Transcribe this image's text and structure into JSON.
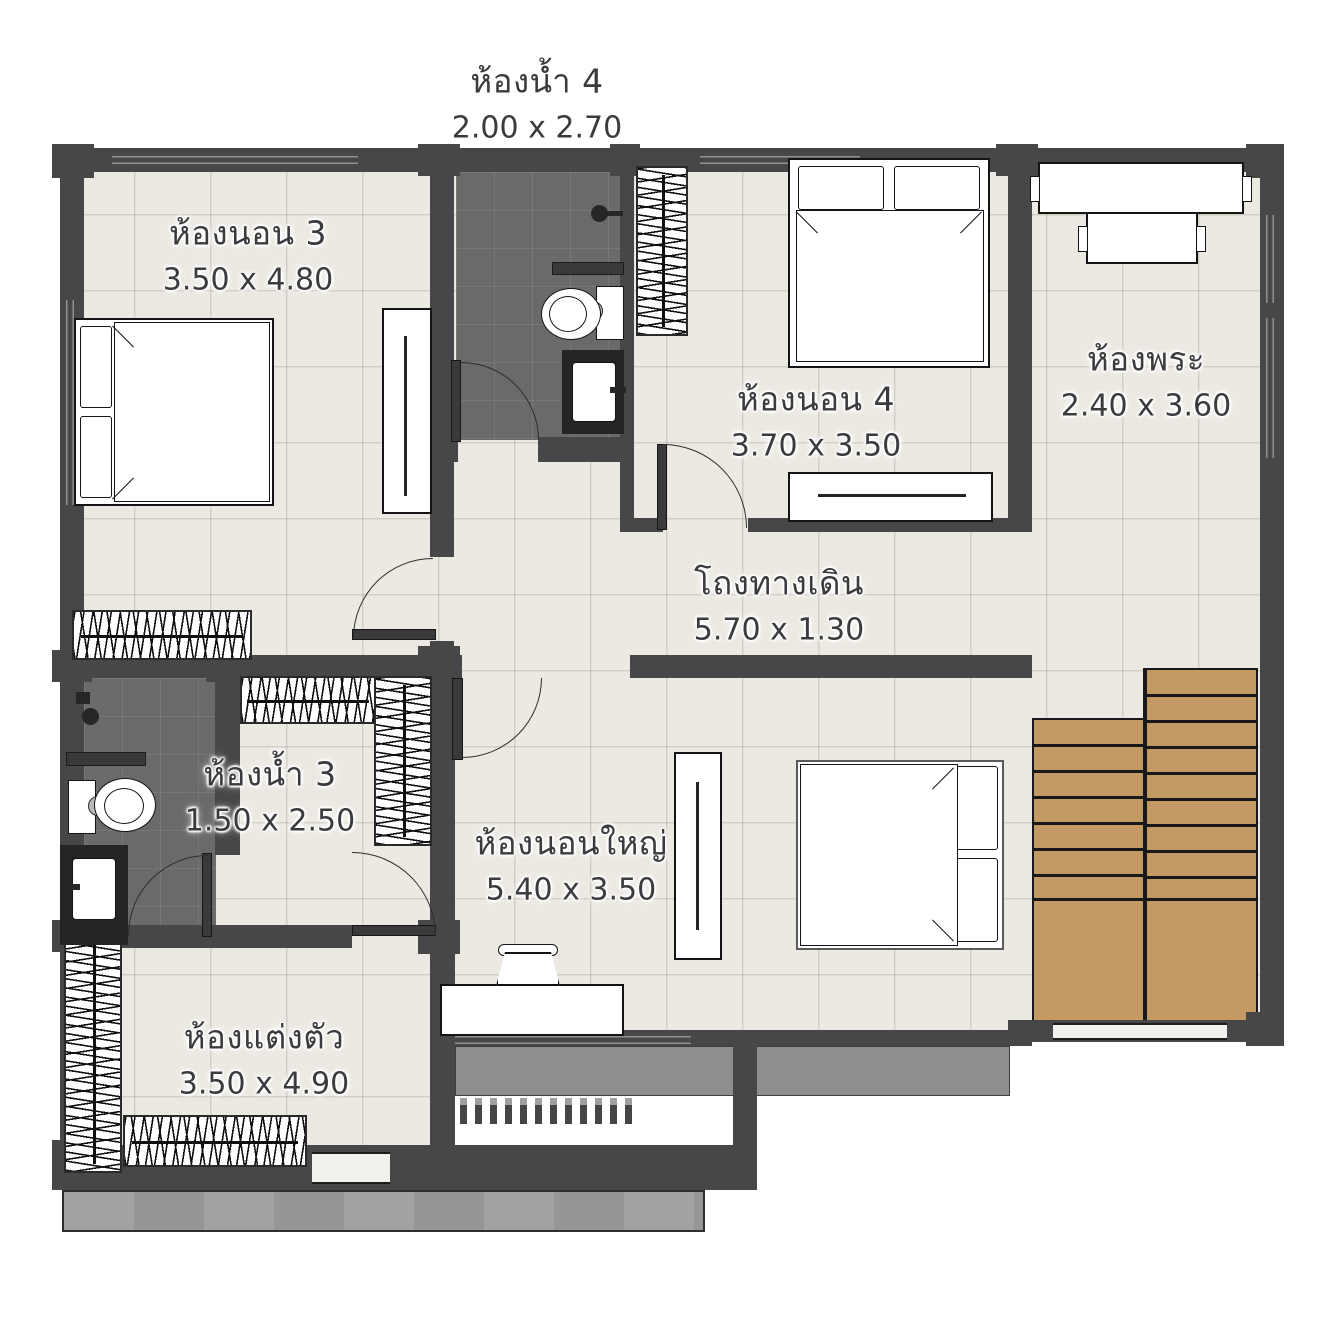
{
  "plan_title": "Second floor plan",
  "rooms": [
    {
      "id": "bedroom-3",
      "name": "ห้องนอน 3",
      "dims": "3.50 x 4.80"
    },
    {
      "id": "bedroom-4",
      "name": "ห้องนอน 4",
      "dims": "3.70 x 3.50"
    },
    {
      "id": "prayer-room",
      "name": "ห้องพระ",
      "dims": "2.40 x 3.60"
    },
    {
      "id": "hallway",
      "name": "โถงทางเดิน",
      "dims": "5.70 x 1.30"
    },
    {
      "id": "bathroom-3",
      "name": "ห้องน้ำ 3",
      "dims": "1.50 x 2.50"
    },
    {
      "id": "master-bedroom",
      "name": "ห้องนอนใหญ่",
      "dims": "5.40 x 3.50"
    },
    {
      "id": "dressing-room",
      "name": "ห้องแต่งตัว",
      "dims": "3.50 x 4.90"
    },
    {
      "id": "bathroom-4",
      "name": "ห้องน้ำ 4",
      "dims": "2.00 x 2.70"
    }
  ],
  "colors": {
    "wall": "#474747",
    "floor_tile": "#ece9e2",
    "bathroom_tile": "#6a6a6a",
    "stair_wood": "#c49a64",
    "balcony_concrete": "#8e8e8e",
    "label_text": "#3b3b3d"
  }
}
